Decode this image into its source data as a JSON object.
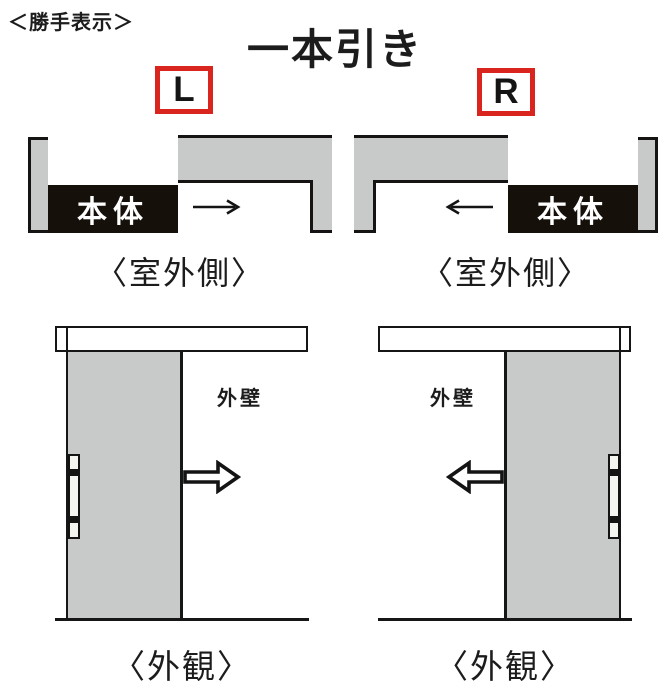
{
  "header": {
    "note": "＜勝手表示＞",
    "title": "一本引き"
  },
  "colors": {
    "red_box_border": "#d9251d",
    "wall_gray": "#c7cac8",
    "body_black": "#16100b",
    "line_black": "#161616"
  },
  "variants": [
    {
      "handing": "L",
      "plan": {
        "body_label": "本体",
        "slide_arrow": "→",
        "slide_direction": "right",
        "caption": "〈室外側〉"
      },
      "elevation": {
        "wall_label": "外壁",
        "slide_direction": "right",
        "caption": "〈外観〉"
      }
    },
    {
      "handing": "R",
      "plan": {
        "body_label": "本体",
        "slide_arrow": "←",
        "slide_direction": "left",
        "caption": "〈室外側〉"
      },
      "elevation": {
        "wall_label": "外壁",
        "slide_direction": "left",
        "caption": "〈外観〉"
      }
    }
  ]
}
